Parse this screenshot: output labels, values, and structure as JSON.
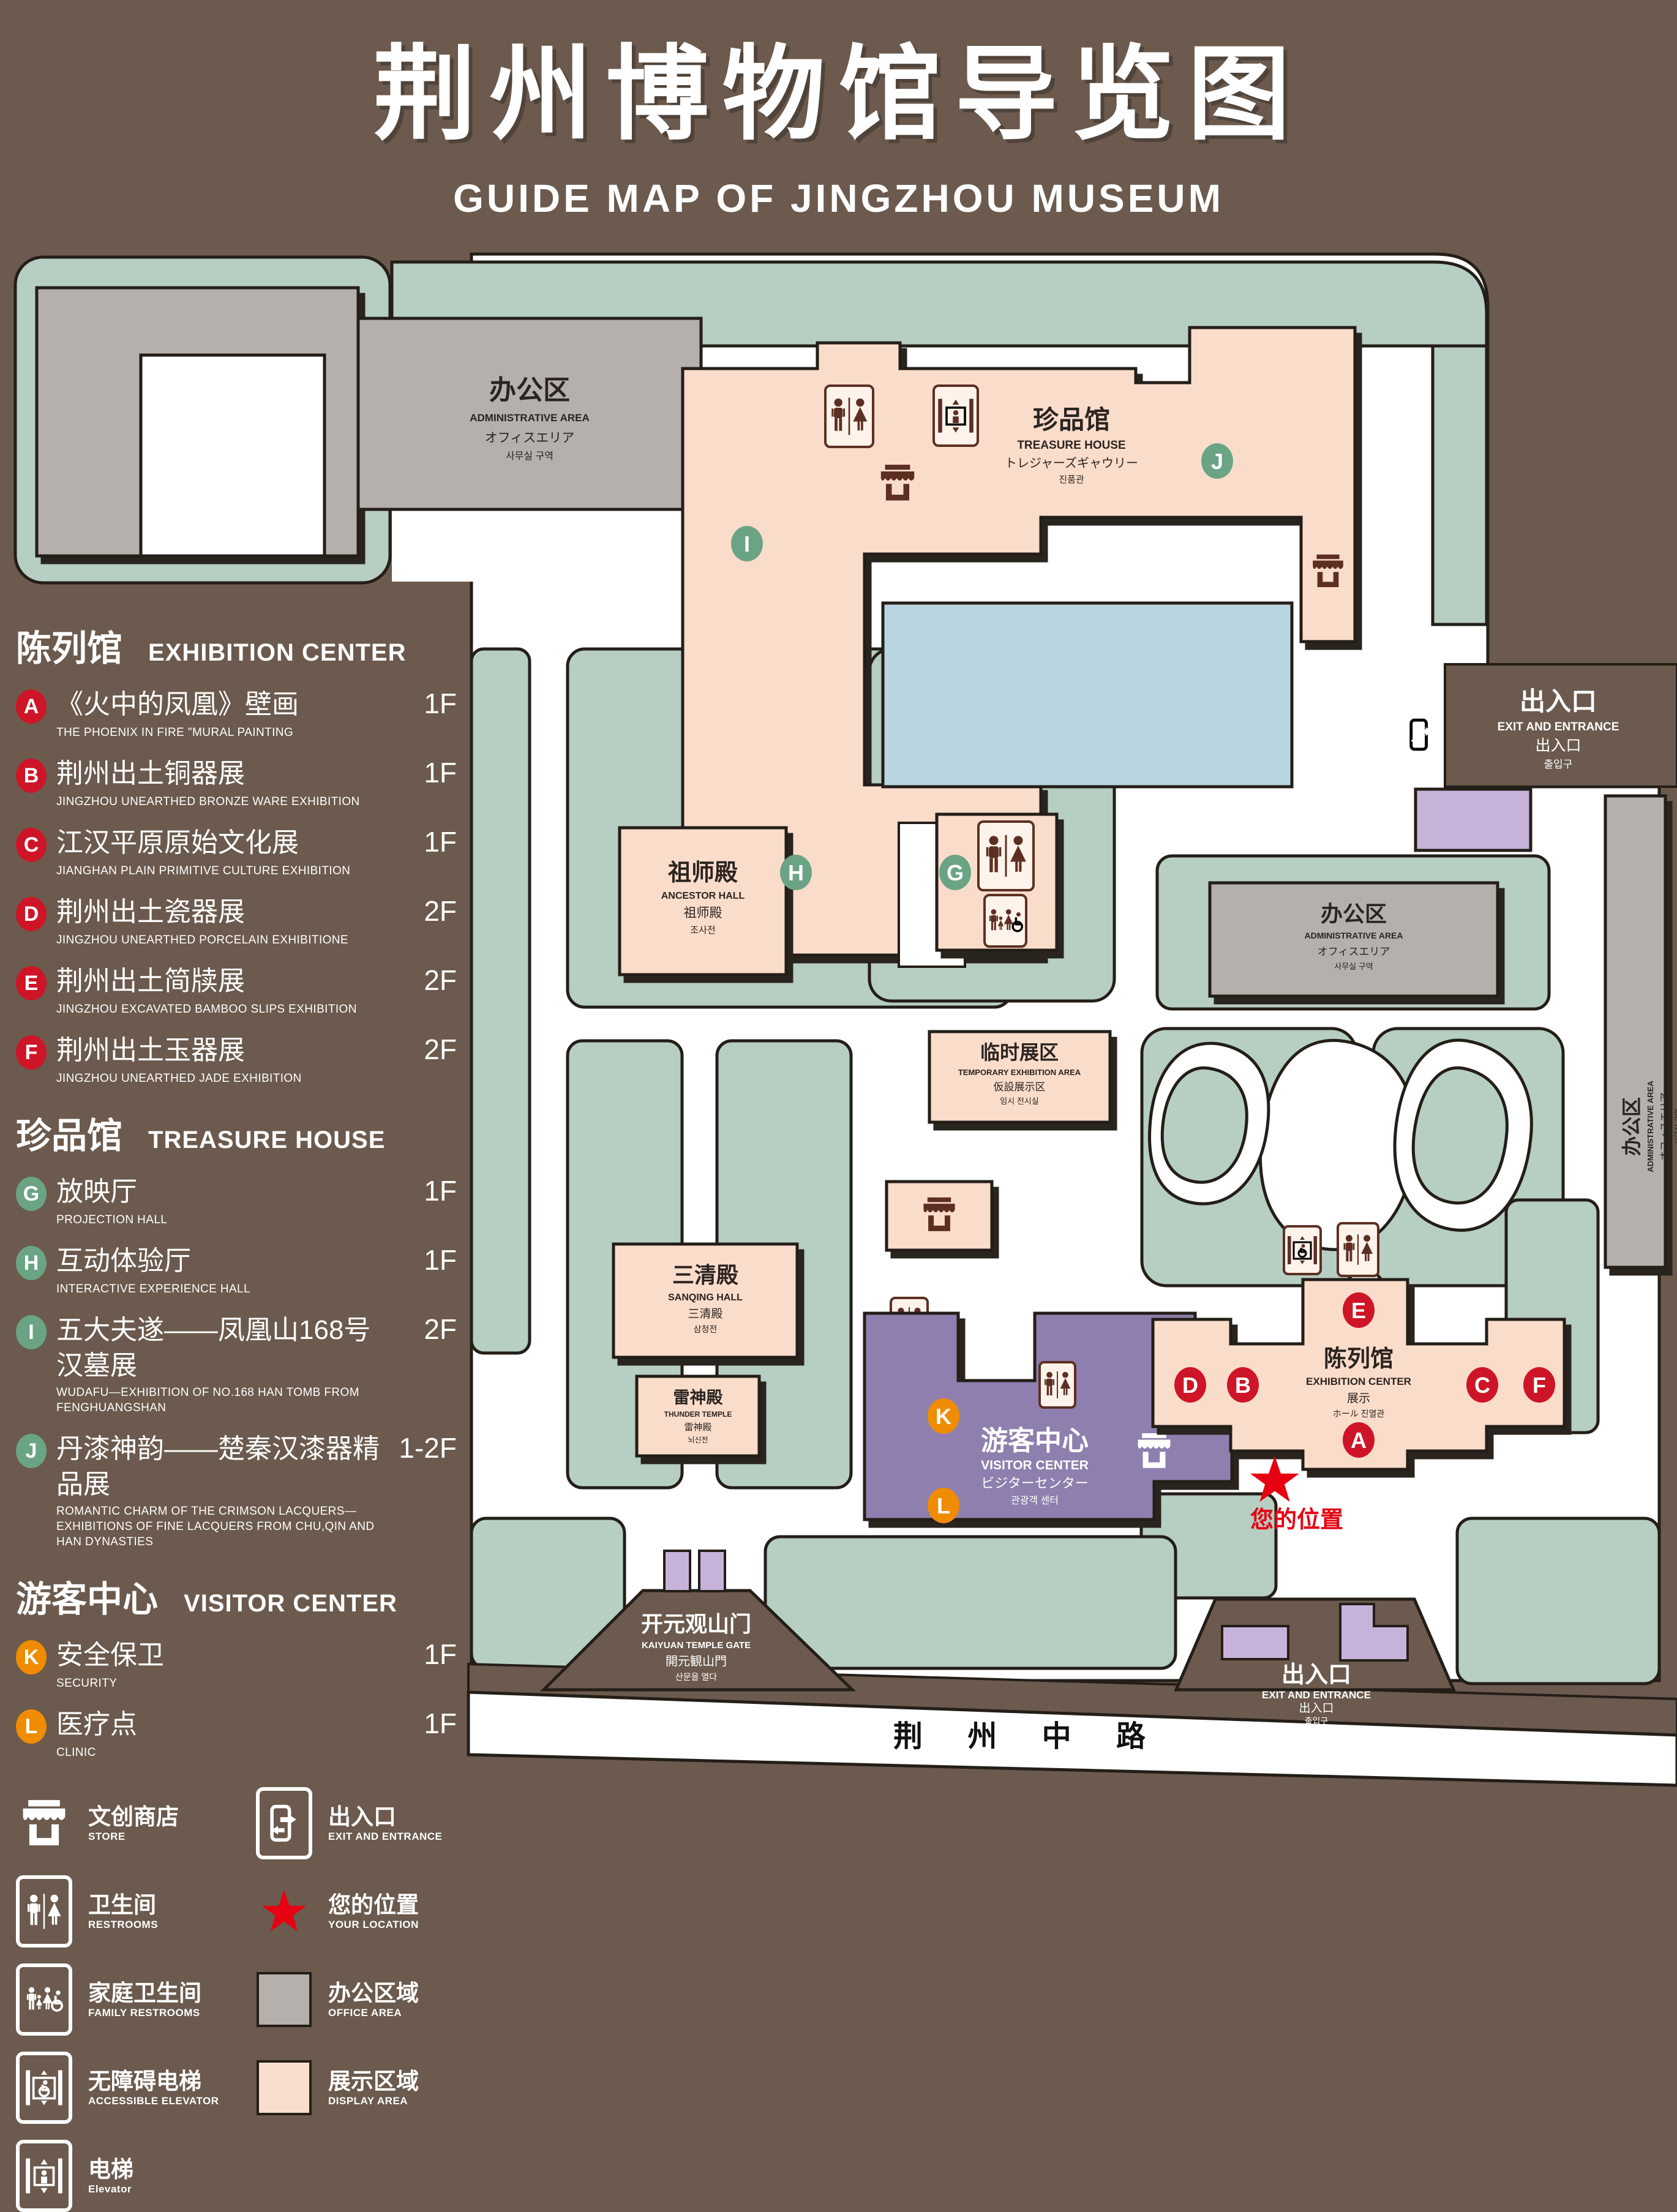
{
  "title": {
    "zh": "荆州博物馆导览图",
    "en": "GUIDE MAP OF JINGZHOU MUSEUM"
  },
  "legend": {
    "sections": [
      {
        "zh": "陈列馆",
        "en": "EXHIBITION CENTER",
        "items": [
          {
            "letter": "A",
            "zh": "《火中的凤凰》壁画",
            "en": "THE PHOENIX IN FIRE \"MURAL PAINTING",
            "floor": "1F"
          },
          {
            "letter": "B",
            "zh": "荆州出土铜器展",
            "en": "JINGZHOU UNEARTHED BRONZE WARE EXHIBITION",
            "floor": "1F"
          },
          {
            "letter": "C",
            "zh": "江汉平原原始文化展",
            "en": "JIANGHAN PLAIN PRIMITIVE CULTURE EXHIBITION",
            "floor": "1F"
          },
          {
            "letter": "D",
            "zh": "荆州出土瓷器展",
            "en": "JINGZHOU UNEARTHED PORCELAIN EXHIBITIONE",
            "floor": "2F"
          },
          {
            "letter": "E",
            "zh": "荆州出土简牍展",
            "en": "JINGZHOU EXCAVATED BAMBOO SLIPS EXHIBITION",
            "floor": "2F"
          },
          {
            "letter": "F",
            "zh": "荆州出土玉器展",
            "en": "JINGZHOU UNEARTHED JADE EXHIBITION",
            "floor": "2F"
          }
        ]
      },
      {
        "zh": "珍品馆",
        "en": "TREASURE HOUSE",
        "items": [
          {
            "letter": "G",
            "zh": "放映厅",
            "en": "PROJECTION HALL",
            "floor": "1F"
          },
          {
            "letter": "H",
            "zh": "互动体验厅",
            "en": "INTERACTIVE EXPERIENCE HALL",
            "floor": "1F"
          },
          {
            "letter": "I",
            "zh": "五大夫遂——凤凰山168号汉墓展",
            "en": "WUDAFU—EXHIBITION OF NO.168 HAN TOMB FROM FENGHUANGSHAN",
            "floor": "2F"
          },
          {
            "letter": "J",
            "zh": "丹漆神韵——楚秦汉漆器精品展",
            "en": "ROMANTIC CHARM OF THE CRIMSON LACQUERS—EXHIBITIONS OF FINE LACQUERS FROM CHU,QIN AND HAN DYNASTIES",
            "floor": "1-2F"
          }
        ]
      },
      {
        "zh": "游客中心",
        "en": "VISITOR CENTER",
        "items": [
          {
            "letter": "K",
            "zh": "安全保卫",
            "en": "SECURITY",
            "floor": "1F"
          },
          {
            "letter": "L",
            "zh": "医疗点",
            "en": "CLINIC",
            "floor": "1F"
          }
        ]
      }
    ],
    "symbols": [
      {
        "zh": "文创商店",
        "en": "STORE"
      },
      {
        "zh": "出入口",
        "en": "EXIT AND ENTRANCE"
      },
      {
        "zh": "卫生间",
        "en": "RESTROOMS"
      },
      {
        "zh": "您的位置",
        "en": "YOUR LOCATION"
      },
      {
        "zh": "家庭卫生间",
        "en": "FAMILY RESTROOMS"
      },
      {
        "zh": "办公区域",
        "en": "OFFICE AREA"
      },
      {
        "zh": "无障碍电梯",
        "en": "ACCESSIBLE ELEVATOR"
      },
      {
        "zh": "展示区域",
        "en": "DISPLAY AREA"
      },
      {
        "zh": "电梯",
        "en": "Elevator"
      }
    ]
  },
  "map": {
    "admin": {
      "zh": "办公区",
      "en": "ADMINISTRATIVE AREA",
      "ja": "オフィスエリア",
      "ko": "사무실 구역"
    },
    "treasure": {
      "zh": "珍品馆",
      "en": "TREASURE HOUSE",
      "ja": "トレジャーズギャウリー",
      "ko": "진품관"
    },
    "ancestor": {
      "zh": "祖师殿",
      "en": "ANCESTOR HALL",
      "zh2": "祖师殿",
      "ko": "조사전"
    },
    "temporary": {
      "zh": "临时展区",
      "en": "TEMPORARY EXHIBITION AREA",
      "ja": "仮設展示区",
      "ko": "임시 전시실"
    },
    "sanqing": {
      "zh": "三清殿",
      "en": "SANQING HALL",
      "zh2": "三清殿",
      "ko": "삼청전"
    },
    "thunder": {
      "zh": "雷神殿",
      "en": "THUNDER TEMPLE",
      "zh2": "雷神殿",
      "ko": "뇌신전"
    },
    "visitor": {
      "zh": "游客中心",
      "en": "VISITOR CENTER",
      "ja": "ビジターセンター",
      "ko": "관광객 센터"
    },
    "exhibition": {
      "zh": "陈列馆",
      "en": "EXHIBITION CENTER",
      "l3": "展示",
      "l4": "ホール 진열관"
    },
    "exit": {
      "zh": "出入口",
      "en": "EXIT AND ENTRANCE",
      "zh2": "出入口",
      "ko": "출입구"
    },
    "gate": {
      "zh": "开元观山门",
      "en": "KAIYUAN TEMPLE GATE",
      "ja": "開元観山門",
      "ko": "산문을 열다"
    },
    "road": "荆 州 中 路",
    "your_location": "您的位置"
  },
  "colors": {
    "background": "#6b5a4d",
    "lawn": "#b7cec2",
    "display_area": "#fadccb",
    "office_area": "#b5b0ac",
    "water": "#b9d6e0",
    "visitor_center": "#8e7fae",
    "gate_purple": "#c7b3da",
    "badge_red": "#ce1527",
    "badge_green": "#6aa484",
    "badge_orange": "#f08c00",
    "icon_maroon": "#5d2f23",
    "location_red": "#e60012"
  }
}
